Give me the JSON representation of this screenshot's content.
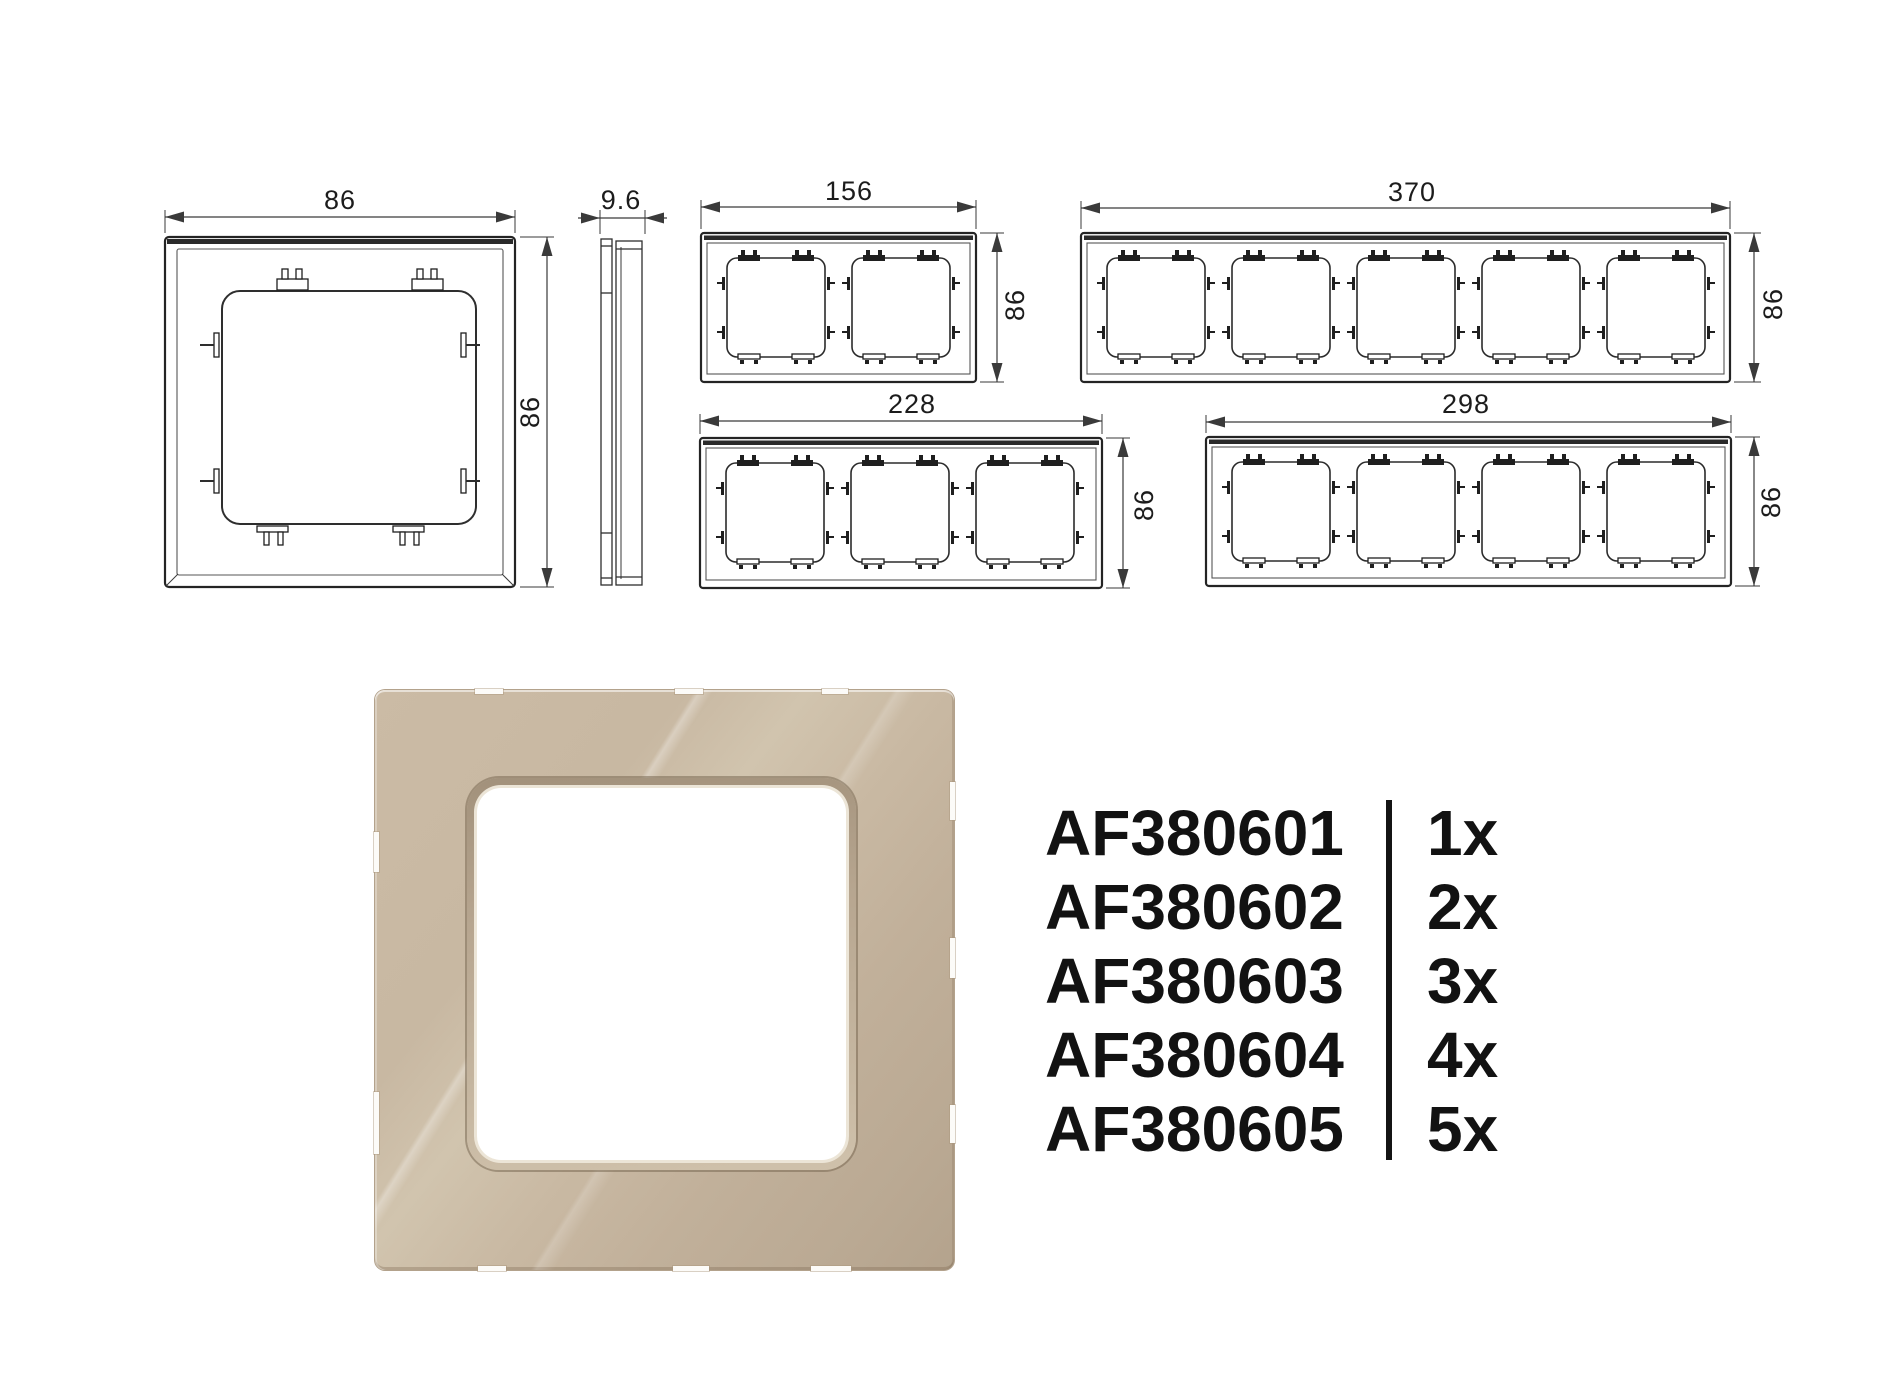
{
  "drawings": {
    "line_color": "#2b2b2b",
    "frames": [
      {
        "name": "single-frame-back-view",
        "gangs": 1,
        "width_mm": "86",
        "height_mm": "86"
      },
      {
        "name": "side-profile",
        "depth_mm": "9.6"
      },
      {
        "name": "two-gang-frame-back-view",
        "gangs": 2,
        "width_mm": "156",
        "height_mm": "86"
      },
      {
        "name": "five-gang-frame-back-view",
        "gangs": 5,
        "width_mm": "370",
        "height_mm": "86"
      },
      {
        "name": "three-gang-frame-back-view",
        "gangs": 3,
        "width_mm": "228",
        "height_mm": "86"
      },
      {
        "name": "four-gang-frame-back-view",
        "gangs": 4,
        "width_mm": "298",
        "height_mm": "86"
      }
    ]
  },
  "product_render": {
    "glass_color": "#c3b29c",
    "highlight_color": "#d2c5af",
    "opening_color": "#ffffff"
  },
  "product_codes": {
    "items": [
      {
        "code": "AF380601",
        "qty": "1x"
      },
      {
        "code": "AF380602",
        "qty": "2x"
      },
      {
        "code": "AF380603",
        "qty": "3x"
      },
      {
        "code": "AF380604",
        "qty": "4x"
      },
      {
        "code": "AF380605",
        "qty": "5x"
      }
    ]
  }
}
